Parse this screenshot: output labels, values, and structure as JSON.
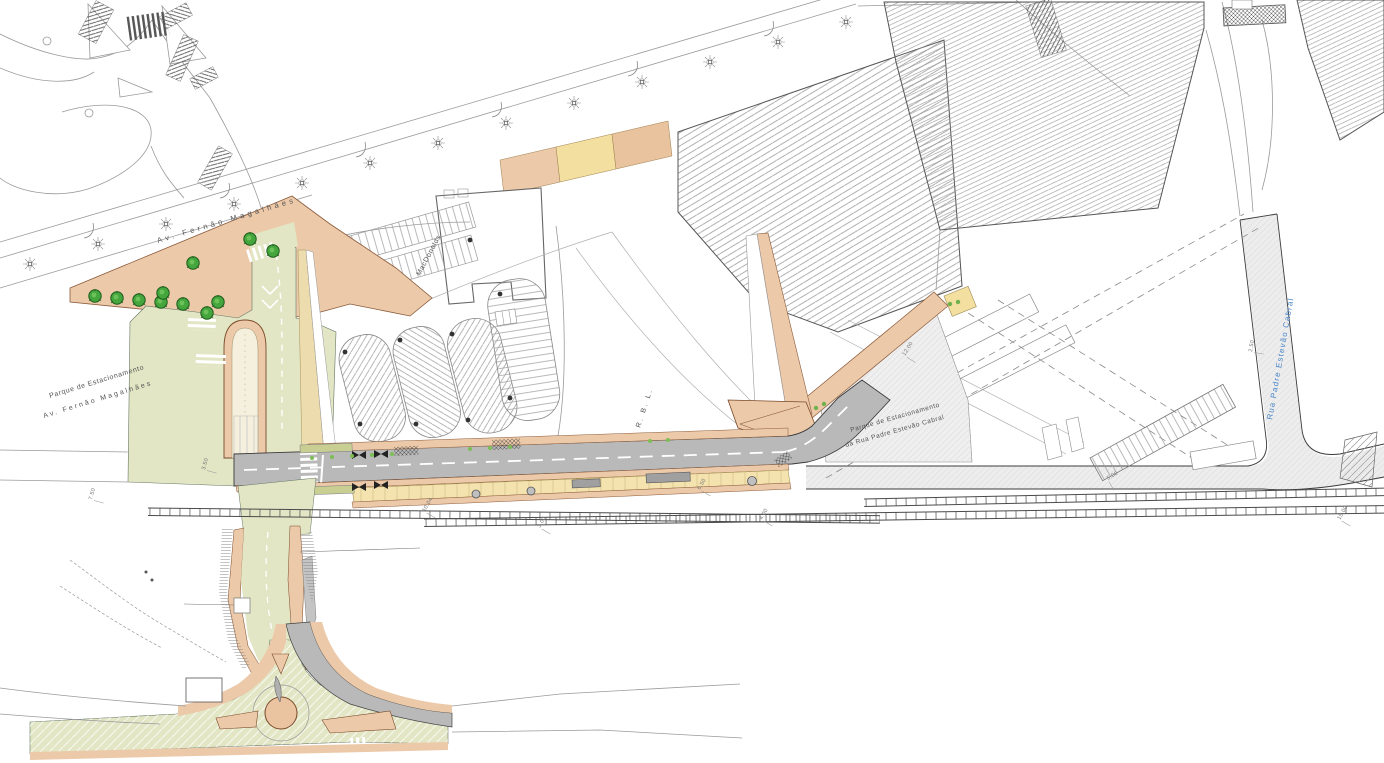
{
  "labels": {
    "avenue_top": "Av. Fernão Magalhães",
    "parking_left_line1": "Parque de Estacionamento",
    "parking_left_line2": "Av. Fernão Magalhães",
    "building_mcdonalds": "MacDonalds",
    "rbl_yard": "R. B. L.",
    "parking_right_line1": "Parque de Estacionamento",
    "parking_right_line2": "da Rua Padre Estevão Cabral",
    "street_right": "Rua Padre Estevão Cabral"
  },
  "dims": [
    "7.50",
    "3.50",
    "10.04",
    "3.00",
    "6.50",
    "12.00",
    "5.00",
    "2.50",
    "15.00",
    "4.00"
  ],
  "colors": {
    "surface_green": "#e2e6c4",
    "sidewalk_salmon": "#ecc9a8",
    "platform_yellow": "#f4e3ae",
    "asphalt_gray": "#b9b9b9",
    "existing_road_gray": "#ededed",
    "tree_green": "#44a63c",
    "street_label_blue": "#4a86c8",
    "line_dark": "#3c3c3c"
  },
  "symbols": {
    "tree": "deciduous-tree-icon",
    "lamp": "street-lamp-icon",
    "crosswalk": "pedestrian-crossing",
    "railway": "railway-track",
    "roundabout": "roundabout-island"
  }
}
